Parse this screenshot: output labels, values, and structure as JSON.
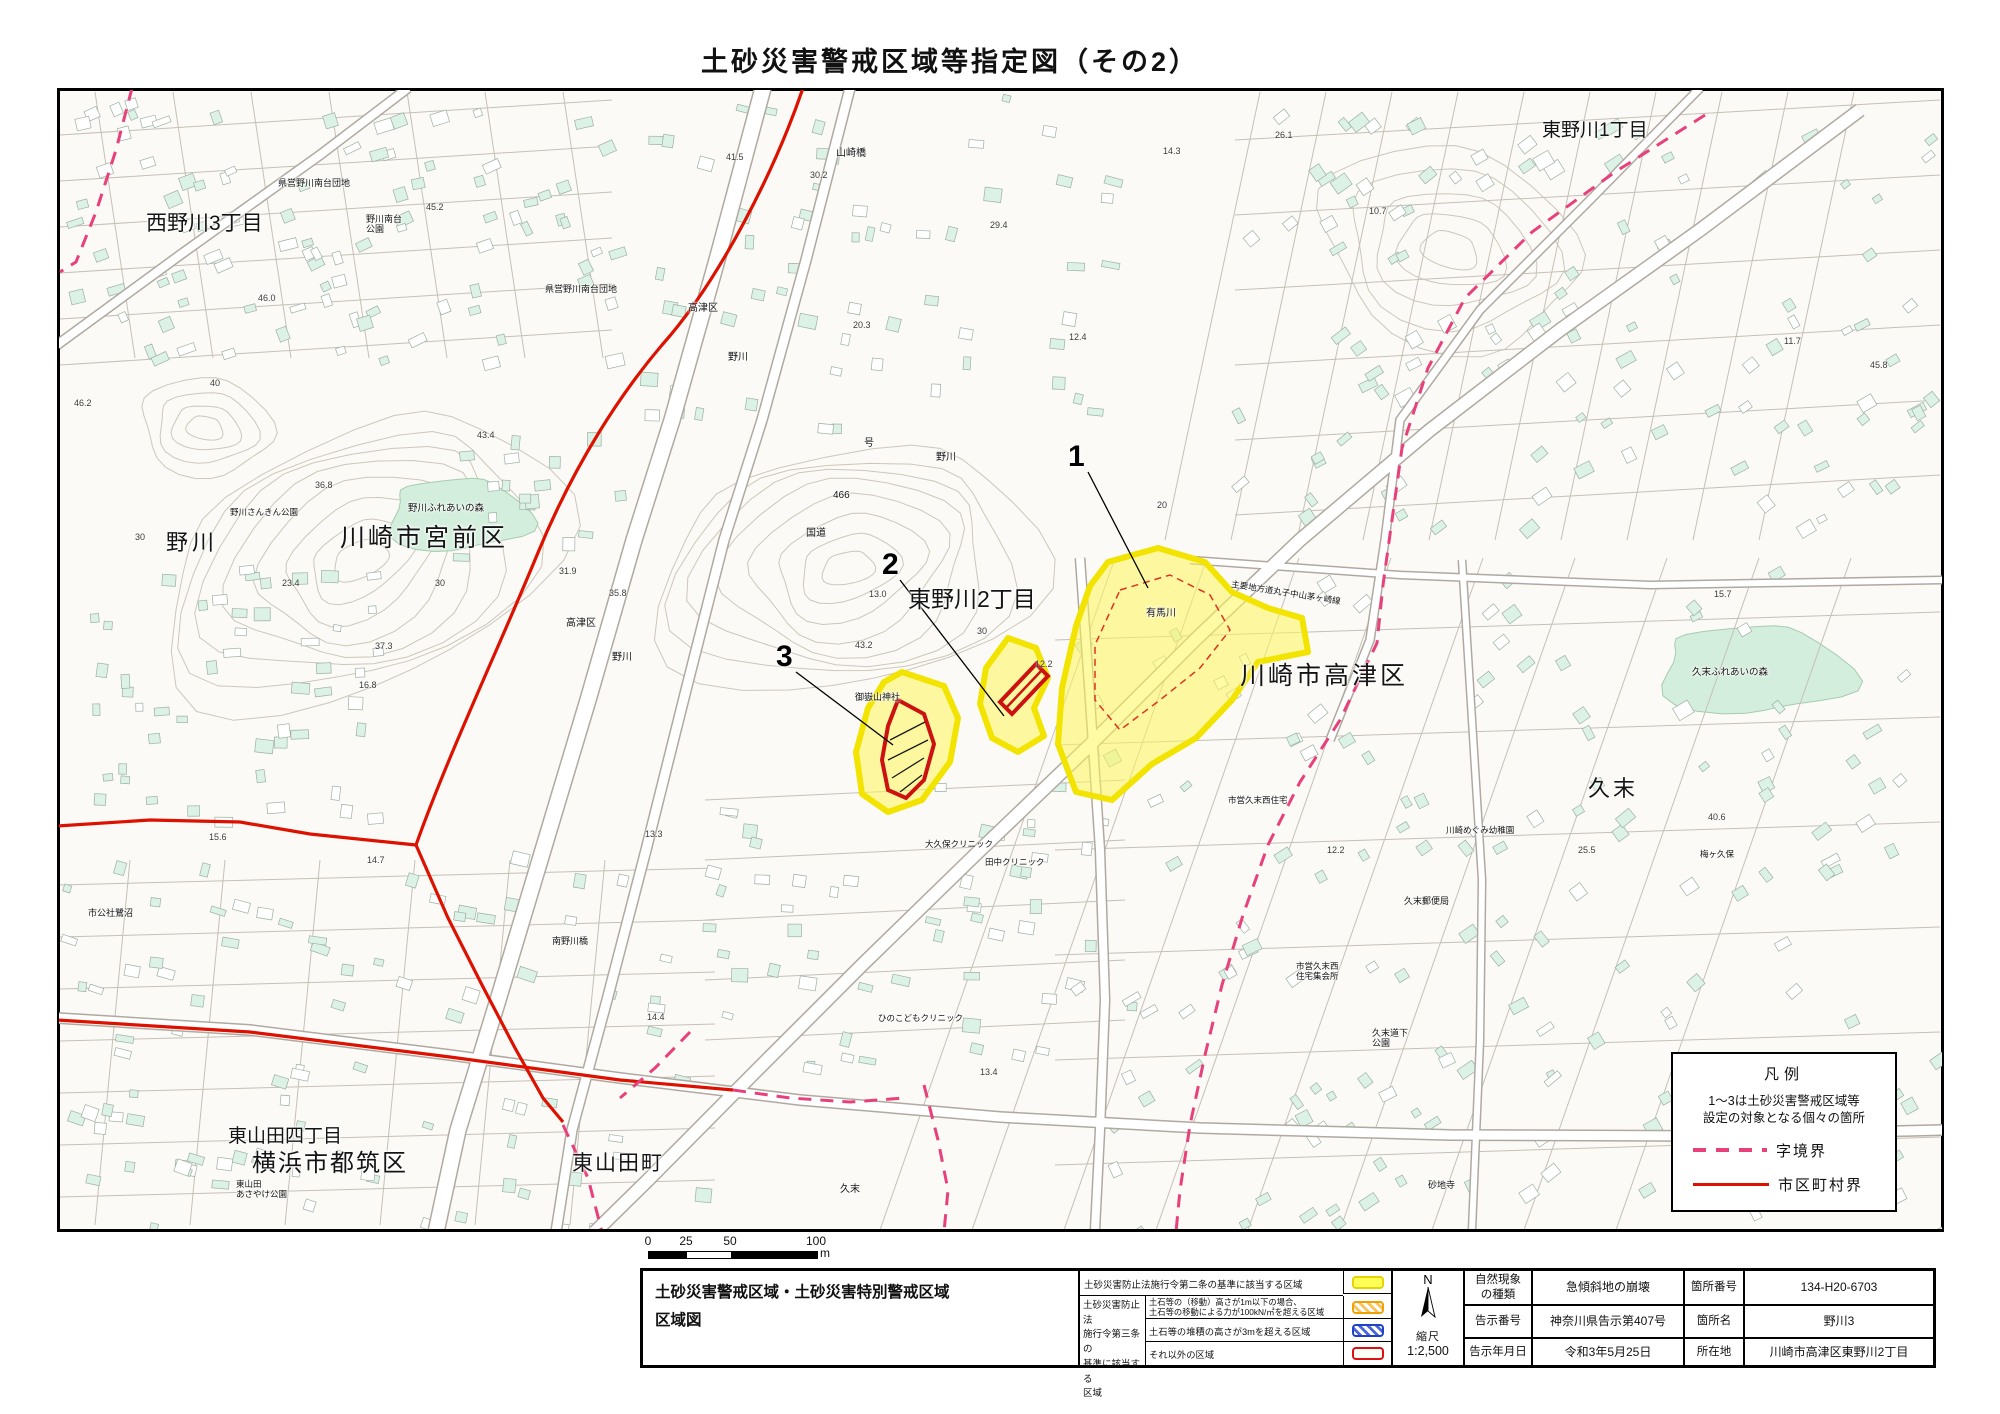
{
  "page_title": "土砂災害警戒区域等指定図（その2）",
  "colors": {
    "boundary_red": "#dd1100",
    "boundary_pink": "#e8407a",
    "zone_fill": "rgba(255,246,90,0.55)",
    "zone_border": "#f2e400",
    "special_red": "#cc1111",
    "building_fill": "#dcf2e6",
    "building_stroke": "#9db0a3",
    "contour": "#cdc7ba",
    "road_casing": "#b0a9a0",
    "park_fill": "#d4eedd"
  },
  "map": {
    "labels": [
      {
        "t": "西野川3丁目",
        "x": 146,
        "y": 212,
        "s": 21
      },
      {
        "t": "東野川1丁目",
        "x": 1542,
        "y": 120,
        "s": 19
      },
      {
        "t": "川崎市宮前区",
        "x": 340,
        "y": 524,
        "s": 25,
        "sp": 3
      },
      {
        "t": "野川",
        "x": 166,
        "y": 530,
        "s": 22,
        "sp": 4
      },
      {
        "t": "東野川2丁目",
        "x": 908,
        "y": 586,
        "s": 23
      },
      {
        "t": "川崎市高津区",
        "x": 1240,
        "y": 662,
        "s": 25,
        "sp": 3
      },
      {
        "t": "久末",
        "x": 1588,
        "y": 776,
        "s": 22,
        "sp": 3
      },
      {
        "t": "東山田四丁目",
        "x": 228,
        "y": 1126,
        "s": 19
      },
      {
        "t": "横浜市都筑区",
        "x": 252,
        "y": 1150,
        "s": 24,
        "sp": 2
      },
      {
        "t": "東山田町",
        "x": 572,
        "y": 1152,
        "s": 21,
        "sp": 2
      },
      {
        "t": "山崎橋",
        "x": 836,
        "y": 148,
        "s": 10
      },
      {
        "t": "県営野川南台団地",
        "x": 278,
        "y": 178,
        "s": 9
      },
      {
        "t": "野川南台\n公園",
        "x": 366,
        "y": 214,
        "s": 9
      },
      {
        "t": "県営野川南台団地",
        "x": 545,
        "y": 284,
        "s": 9
      },
      {
        "t": "高津区",
        "x": 688,
        "y": 303,
        "s": 10
      },
      {
        "t": "野川",
        "x": 728,
        "y": 352,
        "s": 10
      },
      {
        "t": "号",
        "x": 864,
        "y": 438,
        "s": 10
      },
      {
        "t": "466",
        "x": 833,
        "y": 490,
        "s": 10
      },
      {
        "t": "国道",
        "x": 806,
        "y": 528,
        "s": 10
      },
      {
        "t": "野川",
        "x": 936,
        "y": 452,
        "s": 10
      },
      {
        "t": "御嶽山神社",
        "x": 855,
        "y": 692,
        "s": 9
      },
      {
        "t": "有馬川",
        "x": 1146,
        "y": 608,
        "s": 10
      },
      {
        "t": "主要地方道丸子中山茅ヶ崎線",
        "x": 1232,
        "y": 580,
        "s": 8.5,
        "r": 9
      },
      {
        "t": "久末ふれあいの森",
        "x": 1692,
        "y": 668,
        "s": 9.5
      },
      {
        "t": "野川ふれあいの森",
        "x": 408,
        "y": 504,
        "s": 9.5
      },
      {
        "t": "野川さんきん公園",
        "x": 230,
        "y": 508,
        "s": 8.5
      },
      {
        "t": "高津区",
        "x": 566,
        "y": 618,
        "s": 10
      },
      {
        "t": "野川",
        "x": 612,
        "y": 652,
        "s": 10
      },
      {
        "t": "大久保クリニック",
        "x": 925,
        "y": 840,
        "s": 8.5
      },
      {
        "t": "田中クリニック",
        "x": 985,
        "y": 858,
        "s": 8.5
      },
      {
        "t": "ひのこどもクリニック",
        "x": 878,
        "y": 1014,
        "s": 8.5
      },
      {
        "t": "南野川橋",
        "x": 552,
        "y": 936,
        "s": 9
      },
      {
        "t": "市営久末西住宅",
        "x": 1228,
        "y": 796,
        "s": 8.5
      },
      {
        "t": "川崎めぐみ幼稚園",
        "x": 1446,
        "y": 826,
        "s": 8.5
      },
      {
        "t": "久末郵便局",
        "x": 1404,
        "y": 896,
        "s": 9
      },
      {
        "t": "市営久末西\n住宅集会所",
        "x": 1296,
        "y": 962,
        "s": 8.5
      },
      {
        "t": "久末道下\n公園",
        "x": 1372,
        "y": 1028,
        "s": 9
      },
      {
        "t": "久末",
        "x": 840,
        "y": 1184,
        "s": 10
      },
      {
        "t": "砂地寺",
        "x": 1428,
        "y": 1180,
        "s": 9
      },
      {
        "t": "梅ヶ久保",
        "x": 1700,
        "y": 850,
        "s": 8.5
      },
      {
        "t": "市公社鷺沼",
        "x": 88,
        "y": 908,
        "s": 9
      },
      {
        "t": "東山田\nあさやけ公園",
        "x": 236,
        "y": 1180,
        "s": 8.5
      }
    ],
    "heights": [
      {
        "t": "41.5",
        "x": 726,
        "y": 152
      },
      {
        "t": "30.2",
        "x": 810,
        "y": 170
      },
      {
        "t": "29.4",
        "x": 990,
        "y": 220
      },
      {
        "t": "20.3",
        "x": 853,
        "y": 320
      },
      {
        "t": "14.3",
        "x": 1163,
        "y": 146
      },
      {
        "t": "10.7",
        "x": 1369,
        "y": 206
      },
      {
        "t": "11.7",
        "x": 1784,
        "y": 336
      },
      {
        "t": "45.2",
        "x": 426,
        "y": 202
      },
      {
        "t": "46.0",
        "x": 258,
        "y": 293
      },
      {
        "t": "40",
        "x": 210,
        "y": 378
      },
      {
        "t": "46.2",
        "x": 74,
        "y": 398
      },
      {
        "t": "43.4",
        "x": 477,
        "y": 430
      },
      {
        "t": "36.8",
        "x": 315,
        "y": 480
      },
      {
        "t": "30",
        "x": 135,
        "y": 532
      },
      {
        "t": "23.4",
        "x": 282,
        "y": 578
      },
      {
        "t": "30",
        "x": 435,
        "y": 578
      },
      {
        "t": "31.9",
        "x": 559,
        "y": 566
      },
      {
        "t": "35.8",
        "x": 609,
        "y": 588
      },
      {
        "t": "37.3",
        "x": 375,
        "y": 641
      },
      {
        "t": "43.2",
        "x": 855,
        "y": 640
      },
      {
        "t": "30",
        "x": 977,
        "y": 626
      },
      {
        "t": "20",
        "x": 1157,
        "y": 500
      },
      {
        "t": "16.8",
        "x": 359,
        "y": 680
      },
      {
        "t": "13.0",
        "x": 869,
        "y": 589
      },
      {
        "t": "12.4",
        "x": 1069,
        "y": 332
      },
      {
        "t": "12.2",
        "x": 1327,
        "y": 845
      },
      {
        "t": "12.2",
        "x": 1035,
        "y": 659
      },
      {
        "t": "15.6",
        "x": 209,
        "y": 832
      },
      {
        "t": "14.7",
        "x": 367,
        "y": 855
      },
      {
        "t": "14.4",
        "x": 647,
        "y": 1012
      },
      {
        "t": "13.3",
        "x": 645,
        "y": 829
      },
      {
        "t": "13.4",
        "x": 980,
        "y": 1067
      },
      {
        "t": "25.5",
        "x": 1578,
        "y": 845
      },
      {
        "t": "40.6",
        "x": 1708,
        "y": 812
      },
      {
        "t": "15.7",
        "x": 1714,
        "y": 589
      },
      {
        "t": "26.1",
        "x": 1275,
        "y": 130
      },
      {
        "t": "45.8",
        "x": 1870,
        "y": 360
      }
    ],
    "sites": [
      {
        "n": "1",
        "x": 1068,
        "y": 440,
        "lx1": 1088,
        "ly1": 472,
        "lx2": 1148,
        "ly2": 588
      },
      {
        "n": "2",
        "x": 882,
        "y": 548,
        "lx1": 900,
        "ly1": 580,
        "lx2": 1004,
        "ly2": 716
      },
      {
        "n": "3",
        "x": 776,
        "y": 640,
        "lx1": 796,
        "ly1": 672,
        "lx2": 893,
        "ly2": 745
      }
    ],
    "legend_box": {
      "title": "凡例",
      "note": "1～3は土砂災害警戒区域等\n設定の対象となる個々の箇所",
      "items": [
        {
          "style": "dashed",
          "label": "字境界"
        },
        {
          "style": "solid",
          "label": "市区町村界"
        }
      ]
    }
  },
  "scale_bar": {
    "ticks": [
      "0",
      "25",
      "50",
      "100"
    ],
    "unit": "m"
  },
  "bottom_table": {
    "map_title": "土砂災害警戒区域・土砂災害特別警戒区域\n区域図",
    "legend": {
      "row1_label": "土砂災害防止法施行令第二条の基準に該当する区域",
      "group_label": "土砂災害防止法\n施行令第三条の\n基準に該当する\n区域",
      "rows": [
        {
          "label": "土石等の（移動）高さが1m以下の場合、\n土石等の移動による力が100kN/㎡を超える区域"
        },
        {
          "label": "土石等の堆積の高さが3mを超える区域"
        },
        {
          "label": "それ以外の区域"
        }
      ]
    },
    "compass": {
      "north": "N",
      "scale_label": "縮尺",
      "scale_value": "1:2,500"
    },
    "info": {
      "r1c1": "自然現象\nの種類",
      "r1c2": "急傾斜地の崩壊",
      "r1c3": "箇所番号",
      "r1c4": "134-H20-6703",
      "r2c1": "告示番号",
      "r2c2": "神奈川県告示第407号",
      "r2c3": "箇所名",
      "r2c4": "野川3",
      "r3c1": "告示年月日",
      "r3c2": "令和3年5月25日",
      "r3c3": "所在地",
      "r3c4": "川崎市高津区東野川2丁目"
    }
  }
}
